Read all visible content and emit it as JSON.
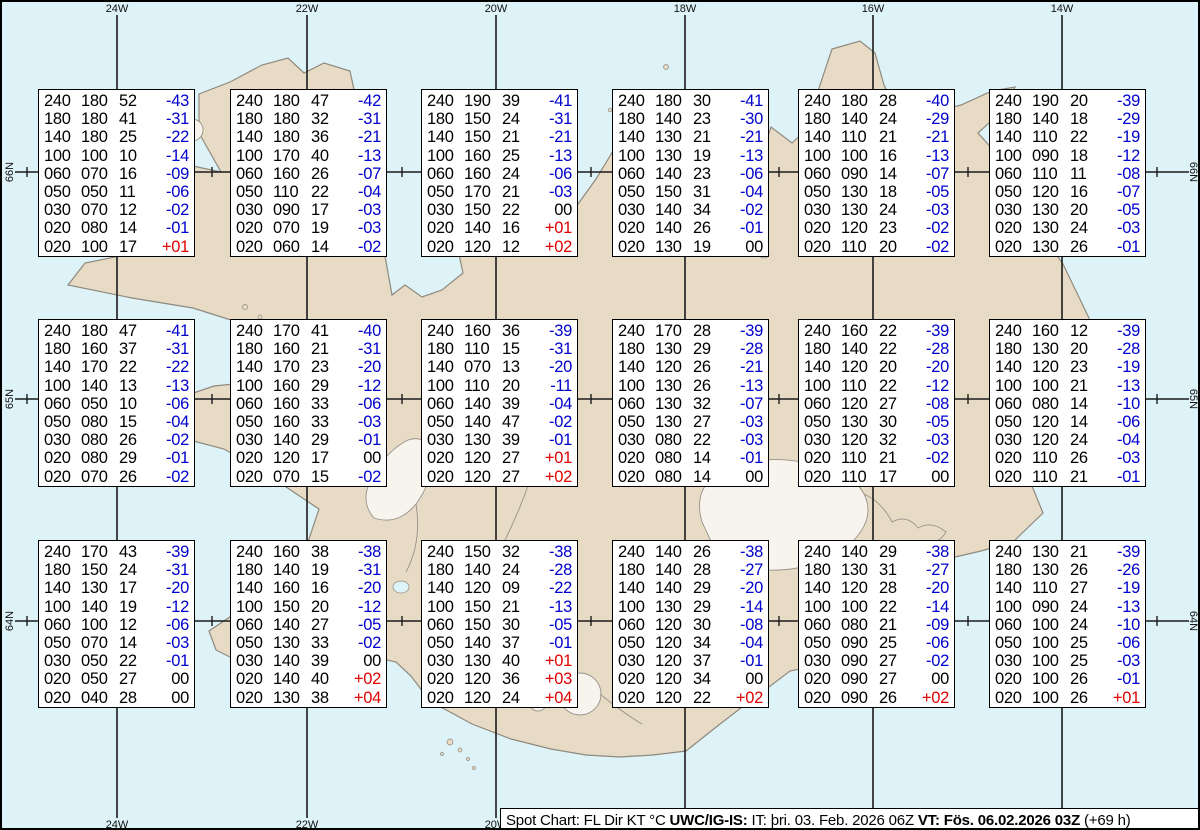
{
  "colors": {
    "water": "#ddf3f8",
    "land": "#e8dbc5",
    "coast": "#8f897e",
    "grid": "#1b1b1b",
    "temp_negative": "#0000cd",
    "temp_positive": "#e00000",
    "text": "#000000"
  },
  "legend": {
    "title": "Spot Chart: FL Dir KT °C ",
    "source": "UWC/IG-IS:",
    "issue_time": " IT: þri. 03. Feb. 2026 06Z ",
    "valid_time": "VT: Fös. 06.02.2026 03Z",
    "forecast_offset": " (+69 h)"
  },
  "chart_data": {
    "type": "table",
    "title": "Spot Chart: FL Dir KT °C",
    "columns": [
      "FL",
      "Dir",
      "KT",
      "°C"
    ],
    "issued": "IT: þri. 03. Feb. 2026 06Z",
    "valid": "VT: Fös. 06.02.2026 03Z (+69 h)",
    "grid": {
      "meridians": [
        {
          "label": "24W"
        },
        {
          "label": "22W"
        },
        {
          "label": "20W"
        },
        {
          "label": "18W"
        },
        {
          "label": "16W"
        },
        {
          "label": "14W"
        }
      ],
      "parallels": [
        {
          "label": "66N"
        },
        {
          "label": "65N"
        },
        {
          "label": "64N"
        }
      ]
    },
    "stations": [
      {
        "row": 1,
        "col": 1,
        "values": [
          [
            "240",
            "180",
            "52",
            "-43"
          ],
          [
            "180",
            "180",
            "41",
            "-31"
          ],
          [
            "140",
            "180",
            "25",
            "-22"
          ],
          [
            "100",
            "100",
            "10",
            "-14"
          ],
          [
            "060",
            "070",
            "16",
            "-09"
          ],
          [
            "050",
            "050",
            "11",
            "-06"
          ],
          [
            "030",
            "070",
            "12",
            "-02"
          ],
          [
            "020",
            "080",
            "14",
            "-01"
          ],
          [
            "020",
            "100",
            "17",
            "+01"
          ]
        ]
      },
      {
        "row": 1,
        "col": 2,
        "values": [
          [
            "240",
            "180",
            "47",
            "-42"
          ],
          [
            "180",
            "180",
            "32",
            "-31"
          ],
          [
            "140",
            "180",
            "36",
            "-21"
          ],
          [
            "100",
            "170",
            "40",
            "-13"
          ],
          [
            "060",
            "160",
            "26",
            "-07"
          ],
          [
            "050",
            "110",
            "22",
            "-04"
          ],
          [
            "030",
            "090",
            "17",
            "-03"
          ],
          [
            "020",
            "070",
            "19",
            "-03"
          ],
          [
            "020",
            "060",
            "14",
            "-02"
          ]
        ]
      },
      {
        "row": 1,
        "col": 3,
        "values": [
          [
            "240",
            "190",
            "39",
            "-41"
          ],
          [
            "180",
            "150",
            "24",
            "-31"
          ],
          [
            "140",
            "150",
            "21",
            "-21"
          ],
          [
            "100",
            "160",
            "25",
            "-13"
          ],
          [
            "060",
            "160",
            "24",
            "-06"
          ],
          [
            "050",
            "170",
            "21",
            "-03"
          ],
          [
            "030",
            "150",
            "22",
            "00"
          ],
          [
            "020",
            "140",
            "16",
            "+01"
          ],
          [
            "020",
            "120",
            "12",
            "+02"
          ]
        ]
      },
      {
        "row": 1,
        "col": 4,
        "values": [
          [
            "240",
            "180",
            "30",
            "-41"
          ],
          [
            "180",
            "140",
            "23",
            "-30"
          ],
          [
            "140",
            "130",
            "21",
            "-21"
          ],
          [
            "100",
            "130",
            "19",
            "-13"
          ],
          [
            "060",
            "140",
            "23",
            "-06"
          ],
          [
            "050",
            "150",
            "31",
            "-04"
          ],
          [
            "030",
            "140",
            "34",
            "-02"
          ],
          [
            "020",
            "140",
            "26",
            "-01"
          ],
          [
            "020",
            "130",
            "19",
            "00"
          ]
        ]
      },
      {
        "row": 1,
        "col": 5,
        "values": [
          [
            "240",
            "180",
            "28",
            "-40"
          ],
          [
            "180",
            "140",
            "24",
            "-29"
          ],
          [
            "140",
            "110",
            "21",
            "-21"
          ],
          [
            "100",
            "100",
            "16",
            "-13"
          ],
          [
            "060",
            "090",
            "14",
            "-07"
          ],
          [
            "050",
            "130",
            "18",
            "-05"
          ],
          [
            "030",
            "130",
            "24",
            "-03"
          ],
          [
            "020",
            "120",
            "23",
            "-02"
          ],
          [
            "020",
            "110",
            "20",
            "-02"
          ]
        ]
      },
      {
        "row": 1,
        "col": 6,
        "values": [
          [
            "240",
            "190",
            "20",
            "-39"
          ],
          [
            "180",
            "140",
            "18",
            "-29"
          ],
          [
            "140",
            "110",
            "22",
            "-19"
          ],
          [
            "100",
            "090",
            "18",
            "-12"
          ],
          [
            "060",
            "110",
            "11",
            "-08"
          ],
          [
            "050",
            "120",
            "16",
            "-07"
          ],
          [
            "030",
            "130",
            "20",
            "-05"
          ],
          [
            "020",
            "130",
            "24",
            "-03"
          ],
          [
            "020",
            "130",
            "26",
            "-01"
          ]
        ]
      },
      {
        "row": 2,
        "col": 1,
        "values": [
          [
            "240",
            "180",
            "47",
            "-41"
          ],
          [
            "180",
            "160",
            "37",
            "-31"
          ],
          [
            "140",
            "170",
            "22",
            "-22"
          ],
          [
            "100",
            "140",
            "13",
            "-13"
          ],
          [
            "060",
            "050",
            "10",
            "-06"
          ],
          [
            "050",
            "080",
            "15",
            "-04"
          ],
          [
            "030",
            "080",
            "26",
            "-02"
          ],
          [
            "020",
            "080",
            "29",
            "-01"
          ],
          [
            "020",
            "070",
            "26",
            "-02"
          ]
        ]
      },
      {
        "row": 2,
        "col": 2,
        "values": [
          [
            "240",
            "170",
            "41",
            "-40"
          ],
          [
            "180",
            "160",
            "21",
            "-31"
          ],
          [
            "140",
            "170",
            "23",
            "-20"
          ],
          [
            "100",
            "160",
            "29",
            "-12"
          ],
          [
            "060",
            "160",
            "33",
            "-06"
          ],
          [
            "050",
            "160",
            "33",
            "-03"
          ],
          [
            "030",
            "140",
            "29",
            "-01"
          ],
          [
            "020",
            "120",
            "17",
            "00"
          ],
          [
            "020",
            "070",
            "15",
            "-02"
          ]
        ]
      },
      {
        "row": 2,
        "col": 3,
        "values": [
          [
            "240",
            "160",
            "36",
            "-39"
          ],
          [
            "180",
            "110",
            "15",
            "-31"
          ],
          [
            "140",
            "070",
            "13",
            "-20"
          ],
          [
            "100",
            "110",
            "20",
            "-11"
          ],
          [
            "060",
            "140",
            "39",
            "-04"
          ],
          [
            "050",
            "140",
            "47",
            "-02"
          ],
          [
            "030",
            "130",
            "39",
            "-01"
          ],
          [
            "020",
            "120",
            "27",
            "+01"
          ],
          [
            "020",
            "120",
            "27",
            "+02"
          ]
        ]
      },
      {
        "row": 2,
        "col": 4,
        "values": [
          [
            "240",
            "170",
            "28",
            "-39"
          ],
          [
            "180",
            "130",
            "29",
            "-28"
          ],
          [
            "140",
            "120",
            "26",
            "-21"
          ],
          [
            "100",
            "130",
            "26",
            "-13"
          ],
          [
            "060",
            "130",
            "32",
            "-07"
          ],
          [
            "050",
            "130",
            "27",
            "-03"
          ],
          [
            "030",
            "080",
            "22",
            "-03"
          ],
          [
            "020",
            "080",
            "14",
            "-01"
          ],
          [
            "020",
            "080",
            "14",
            "00"
          ]
        ]
      },
      {
        "row": 2,
        "col": 5,
        "values": [
          [
            "240",
            "160",
            "22",
            "-39"
          ],
          [
            "180",
            "140",
            "22",
            "-28"
          ],
          [
            "140",
            "120",
            "20",
            "-20"
          ],
          [
            "100",
            "110",
            "22",
            "-12"
          ],
          [
            "060",
            "120",
            "27",
            "-08"
          ],
          [
            "050",
            "130",
            "30",
            "-05"
          ],
          [
            "030",
            "120",
            "32",
            "-03"
          ],
          [
            "020",
            "110",
            "21",
            "-02"
          ],
          [
            "020",
            "110",
            "17",
            "00"
          ]
        ]
      },
      {
        "row": 2,
        "col": 6,
        "values": [
          [
            "240",
            "160",
            "12",
            "-39"
          ],
          [
            "180",
            "130",
            "20",
            "-28"
          ],
          [
            "140",
            "120",
            "23",
            "-19"
          ],
          [
            "100",
            "100",
            "21",
            "-13"
          ],
          [
            "060",
            "080",
            "14",
            "-10"
          ],
          [
            "050",
            "120",
            "14",
            "-06"
          ],
          [
            "030",
            "120",
            "24",
            "-04"
          ],
          [
            "020",
            "110",
            "26",
            "-03"
          ],
          [
            "020",
            "110",
            "21",
            "-01"
          ]
        ]
      },
      {
        "row": 3,
        "col": 1,
        "values": [
          [
            "240",
            "170",
            "43",
            "-39"
          ],
          [
            "180",
            "150",
            "24",
            "-31"
          ],
          [
            "140",
            "130",
            "17",
            "-20"
          ],
          [
            "100",
            "140",
            "19",
            "-12"
          ],
          [
            "060",
            "100",
            "12",
            "-06"
          ],
          [
            "050",
            "070",
            "14",
            "-03"
          ],
          [
            "030",
            "050",
            "22",
            "-01"
          ],
          [
            "020",
            "050",
            "27",
            "00"
          ],
          [
            "020",
            "040",
            "28",
            "00"
          ]
        ]
      },
      {
        "row": 3,
        "col": 2,
        "values": [
          [
            "240",
            "160",
            "38",
            "-38"
          ],
          [
            "180",
            "140",
            "19",
            "-31"
          ],
          [
            "140",
            "160",
            "16",
            "-20"
          ],
          [
            "100",
            "150",
            "20",
            "-12"
          ],
          [
            "060",
            "140",
            "27",
            "-05"
          ],
          [
            "050",
            "130",
            "33",
            "-02"
          ],
          [
            "030",
            "140",
            "39",
            "00"
          ],
          [
            "020",
            "140",
            "40",
            "+02"
          ],
          [
            "020",
            "130",
            "38",
            "+04"
          ]
        ]
      },
      {
        "row": 3,
        "col": 3,
        "values": [
          [
            "240",
            "150",
            "32",
            "-38"
          ],
          [
            "180",
            "140",
            "24",
            "-28"
          ],
          [
            "140",
            "120",
            "09",
            "-22"
          ],
          [
            "100",
            "150",
            "21",
            "-13"
          ],
          [
            "060",
            "150",
            "30",
            "-05"
          ],
          [
            "050",
            "140",
            "37",
            "-01"
          ],
          [
            "030",
            "130",
            "40",
            "+01"
          ],
          [
            "020",
            "120",
            "36",
            "+03"
          ],
          [
            "020",
            "120",
            "24",
            "+04"
          ]
        ]
      },
      {
        "row": 3,
        "col": 4,
        "values": [
          [
            "240",
            "140",
            "26",
            "-38"
          ],
          [
            "180",
            "140",
            "28",
            "-27"
          ],
          [
            "140",
            "140",
            "29",
            "-20"
          ],
          [
            "100",
            "130",
            "29",
            "-14"
          ],
          [
            "060",
            "120",
            "30",
            "-08"
          ],
          [
            "050",
            "120",
            "34",
            "-04"
          ],
          [
            "030",
            "120",
            "37",
            "-01"
          ],
          [
            "020",
            "120",
            "34",
            "00"
          ],
          [
            "020",
            "120",
            "22",
            "+02"
          ]
        ]
      },
      {
        "row": 3,
        "col": 5,
        "values": [
          [
            "240",
            "140",
            "29",
            "-38"
          ],
          [
            "180",
            "130",
            "31",
            "-27"
          ],
          [
            "140",
            "120",
            "28",
            "-20"
          ],
          [
            "100",
            "100",
            "22",
            "-14"
          ],
          [
            "060",
            "080",
            "21",
            "-09"
          ],
          [
            "050",
            "090",
            "25",
            "-06"
          ],
          [
            "030",
            "090",
            "27",
            "-02"
          ],
          [
            "020",
            "090",
            "27",
            "00"
          ],
          [
            "020",
            "090",
            "26",
            "+02"
          ]
        ]
      },
      {
        "row": 3,
        "col": 6,
        "values": [
          [
            "240",
            "130",
            "21",
            "-39"
          ],
          [
            "180",
            "130",
            "26",
            "-26"
          ],
          [
            "140",
            "110",
            "27",
            "-19"
          ],
          [
            "100",
            "090",
            "24",
            "-13"
          ],
          [
            "060",
            "100",
            "24",
            "-10"
          ],
          [
            "050",
            "100",
            "25",
            "-06"
          ],
          [
            "030",
            "100",
            "25",
            "-03"
          ],
          [
            "020",
            "100",
            "26",
            "-01"
          ],
          [
            "020",
            "100",
            "26",
            "+01"
          ]
        ]
      }
    ]
  }
}
